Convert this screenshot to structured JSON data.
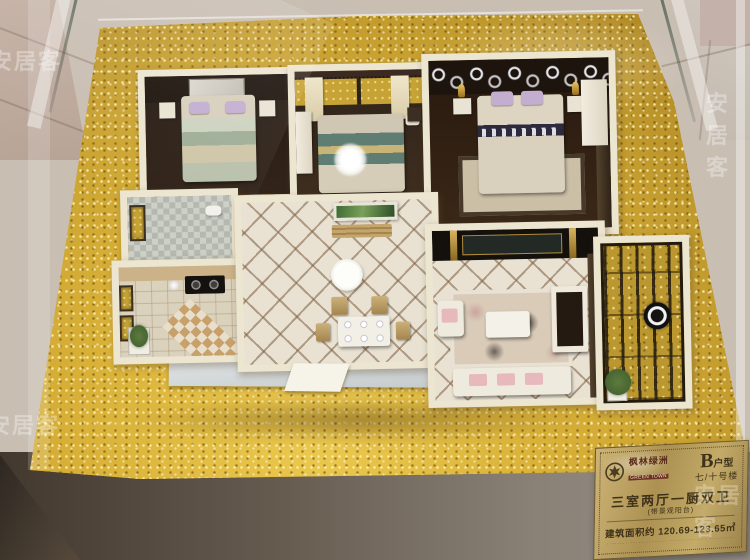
{
  "watermark": {
    "text": "安居客"
  },
  "plaque": {
    "brand_cn": "枫林绿洲",
    "brand_en": "GREEN TOWN",
    "unit_letter": "B",
    "unit_suffix": "户型",
    "building_no": "七/十号楼",
    "layout_title": "三室两厅一厨双卫",
    "layout_note": "(带景观阳台)",
    "area_line": "建筑面积约 120.69-123.65㎡",
    "fine_print": "········ ·············· ·············· ·········"
  },
  "colors": {
    "backdrop_tile": "#c9beb2",
    "gold_base": "#c9a231",
    "gold_highlight": "#ecc94f",
    "gold_shadow": "#a47d1f",
    "wall_white": "#ece5d0",
    "floor_dark": "#33241a",
    "tile_cream": "#e9e2d3",
    "platform_silver": "#bcc2c4",
    "plaque_gold": "#ac9152",
    "plaque_text": "#3f3218",
    "pink_cushion": "#e7b9bc",
    "lavender_pillow": "#c3aed0",
    "plant_green": "#3e5c2c"
  }
}
